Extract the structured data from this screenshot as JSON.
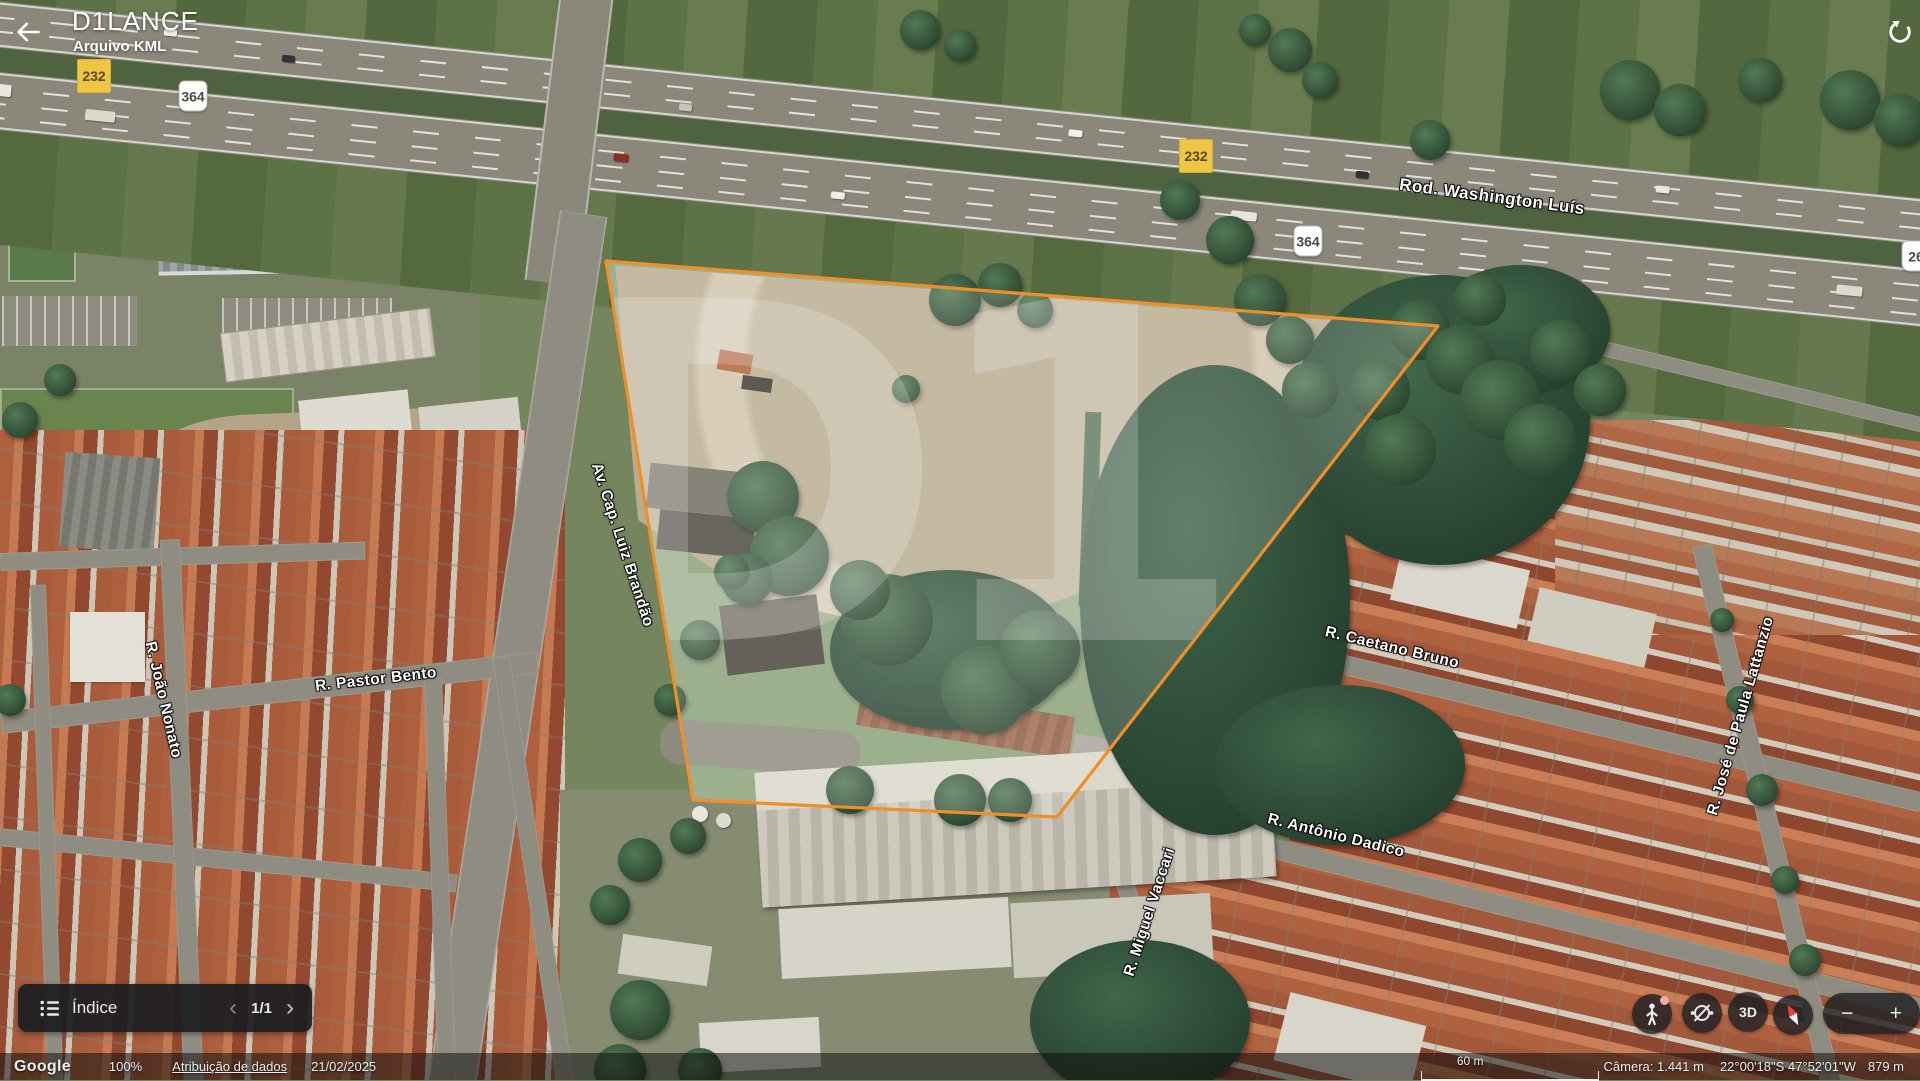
{
  "header": {
    "title": "D1LANCE",
    "subtitle": "Arquivo KML"
  },
  "map": {
    "road_labels": [
      "Rod. Washington Luís",
      "Av. Cap. Luiz Brandão",
      "R. Pastor Bento",
      "R. João Nonato",
      "R. Caetano Bruno",
      "R. Antônio Dadico",
      "R. Miguel Vaccari",
      "R. José de Paula Lattanzio"
    ],
    "shields": {
      "yellow": "232",
      "white": "364",
      "partial": "26"
    }
  },
  "watermark": "D1",
  "index_panel": {
    "label": "Índice",
    "page": "1/1",
    "prev": "‹",
    "next": "›"
  },
  "controls": {
    "three_d": "3D",
    "zoom_in": "+",
    "zoom_out": "−"
  },
  "status_bar": {
    "logo": "Google",
    "zoom": "100%",
    "attribution": "Atribuição de dados",
    "date": "21/02/2025",
    "scale": "60 m",
    "camera": "Câmera: 1.441 m",
    "coords": "22°00'18\"S 47°52'01\"W",
    "elevation": "879 m"
  },
  "colors": {
    "polygon": "#ee8f2a",
    "shield_yellow": "#efc643"
  }
}
